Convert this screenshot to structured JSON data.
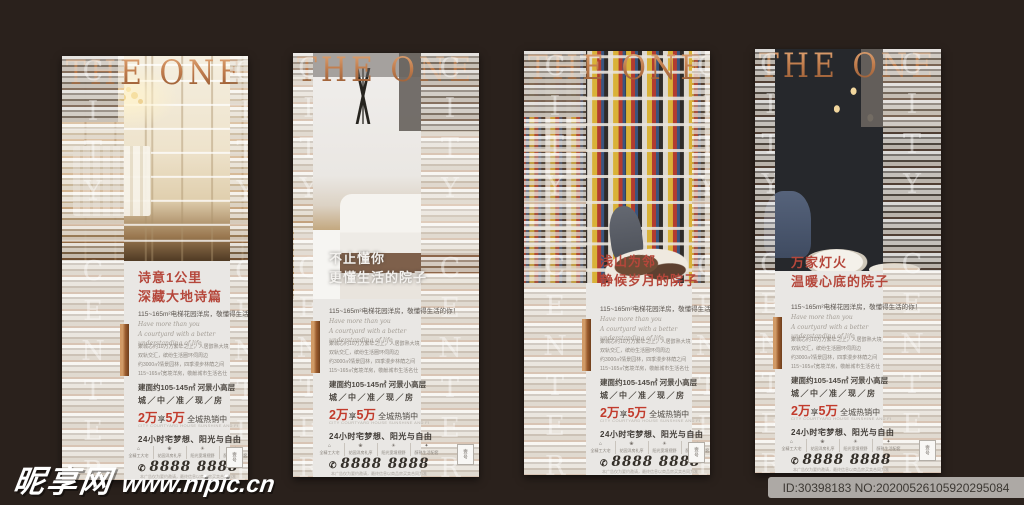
{
  "colors": {
    "background": "#2a211c",
    "copper": "#b4714a",
    "headline_red": "#b5473b",
    "promo_red": "#c23b2c",
    "card_bg": "#e9e7e4"
  },
  "brand": {
    "title": "THE ONE",
    "vertical_text": "CITY CENTER"
  },
  "posters": [
    {
      "headline1": "诗意1公里",
      "headline2": "深藏大地诗篇"
    },
    {
      "headline1": "不止懂你",
      "headline2": "更懂生活的院子"
    },
    {
      "headline1": "浅山为邻",
      "headline2": "静候岁月的院子"
    },
    {
      "headline1": "万家灯火",
      "headline2": "温暖心底的院子"
    }
  ],
  "shared": {
    "subline": "115~165m²电梯花园洋房，敬懂得生活的你！",
    "english_line1": "Have more than you",
    "english_line2": "A courtyard with a better understanding of life",
    "detail_lines": [
      "聚城芯约10万方繁华之上，人居醇熟大境",
      "双轨交汇，缤纷生活圈环伺周边",
      "约3000㎡情景园林，四季漫步林荫之间",
      "115~165㎡宽境洋房，敬献城市生活名仕"
    ],
    "area_line": "建面约105-145㎡ 河景小高层",
    "status_line": "城／中／准／现／房",
    "promo": {
      "n1": "2万",
      "mid": "享",
      "n2": "5万",
      "rest": " 全城热销中"
    },
    "promo_note": "CITY COURTYARD HOUSE SUNSHINE AND FREEDOM ALL THE TIME",
    "slogan": "24小时宅梦想、阳光与自由",
    "features": [
      {
        "icon": "⌂",
        "label": "全精工大宅"
      },
      {
        "icon": "❀",
        "label": "花园洋房礼序"
      },
      {
        "icon": "☀",
        "label": "阳光宽境视野"
      },
      {
        "icon": "✦",
        "label": "醇熟生活配套"
      }
    ],
    "phone_icon": "✆",
    "phone": "8888 8888",
    "disclaimer": "本广告仅为要约邀请，最终信息以商品房买卖合同为准",
    "stamp": "壹号"
  },
  "watermark": {
    "site": "昵享网",
    "url": "www.nipic.cn"
  },
  "id_bar": {
    "text": "ID:30398183 NO:20200526105920295084"
  }
}
